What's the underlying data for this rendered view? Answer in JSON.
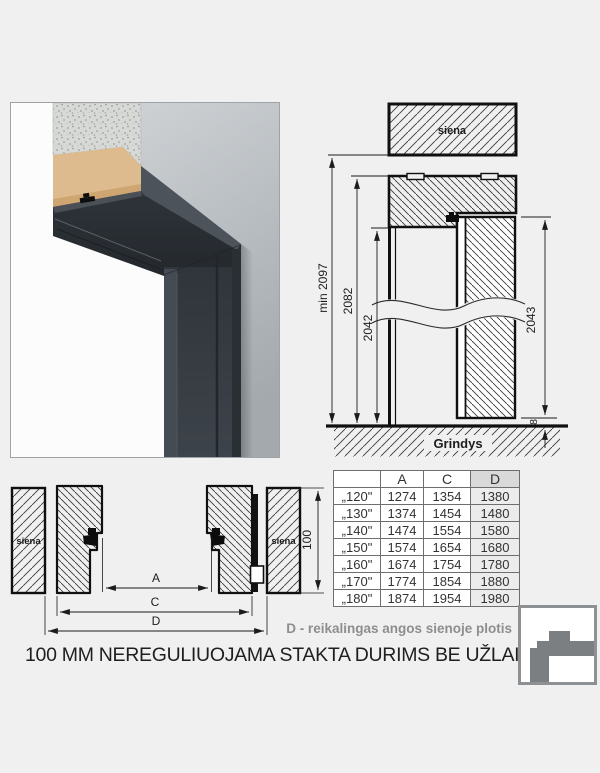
{
  "page": {
    "title": "100 MM NEREGULIUOJAMA STAKTA DURIMS BE UŽLAIDOS",
    "d_note": "D - reikalingas angos sienoje plotis"
  },
  "vertical_section": {
    "wall_label": "siena",
    "floor_label": "Grindys",
    "dim_min_height": "min 2097",
    "dim_frame_height": "2082",
    "dim_clear_height": "2042",
    "dim_door_height": "2043",
    "dim_floor_gap": "8"
  },
  "horizontal_section": {
    "left_wall_label": "siena",
    "right_wall_label": "siena",
    "dim_a": "A",
    "dim_c": "C",
    "dim_d": "D",
    "dim_depth": "100"
  },
  "size_table": {
    "headers": [
      "",
      "A",
      "C",
      "D"
    ],
    "rows": [
      [
        "„120\"",
        "1274",
        "1354",
        "1380"
      ],
      [
        "„130\"",
        "1374",
        "1454",
        "1480"
      ],
      [
        "„140\"",
        "1474",
        "1554",
        "1580"
      ],
      [
        "„150\"",
        "1574",
        "1654",
        "1680"
      ],
      [
        "„160\"",
        "1674",
        "1754",
        "1780"
      ],
      [
        "„170\"",
        "1774",
        "1854",
        "1880"
      ],
      [
        "„180\"",
        "1874",
        "1954",
        "1980"
      ]
    ]
  },
  "colors": {
    "frame_anthracite": "#343a40",
    "wall_gray": "#b3b8bc",
    "table_d_header_bg": "#d9d9d9",
    "table_d_cell_bg": "#ececec",
    "note_gray": "#8e8e8e"
  }
}
